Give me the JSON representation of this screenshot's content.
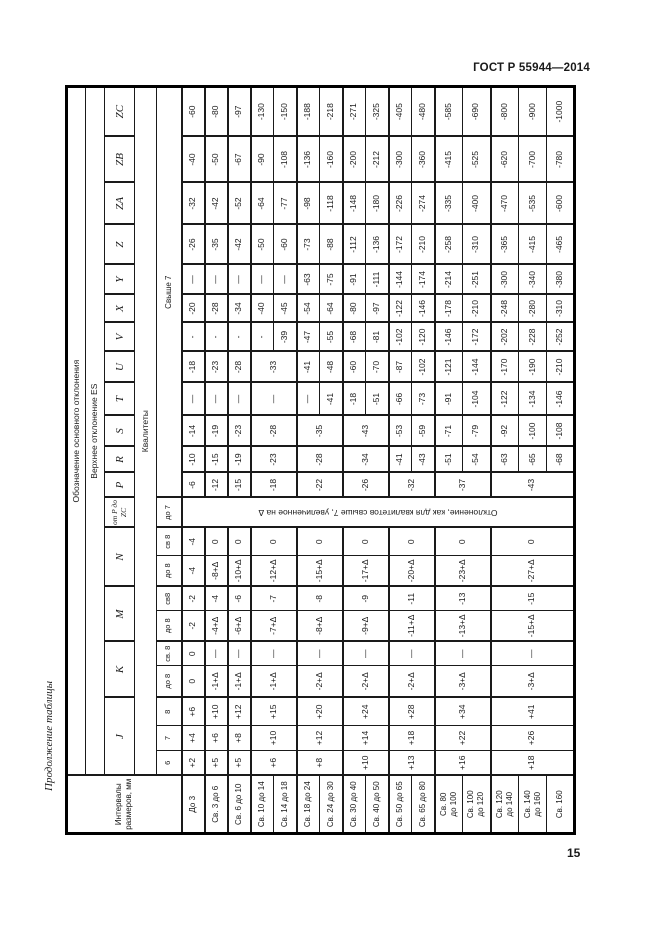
{
  "page": {
    "standard": "ГОСТ Р 55944—2014",
    "number": "15",
    "continuation": "Продолжение таблицы"
  },
  "table": {
    "corner": "Интервалы размеров, мм",
    "h1": "Обозначение основного отклонения",
    "h2": "Верхнее отклонение ES",
    "h4": "Квалитеты",
    "letters": [
      {
        "label": "J",
        "span": 3
      },
      {
        "label": "K",
        "span": 2
      },
      {
        "label": "M",
        "span": 2
      },
      {
        "label": "N",
        "span": 2
      },
      {
        "label": "от P до ZC",
        "span": 1
      },
      {
        "label": "P",
        "span": 1
      },
      {
        "label": "R",
        "span": 1
      },
      {
        "label": "S",
        "span": 1
      },
      {
        "label": "T",
        "span": 1
      },
      {
        "label": "U",
        "span": 1
      },
      {
        "label": "V",
        "span": 1
      },
      {
        "label": "X",
        "span": 1
      },
      {
        "label": "Y",
        "span": 1
      },
      {
        "label": "Z",
        "span": 1
      },
      {
        "label": "ZA",
        "span": 1
      },
      {
        "label": "ZB",
        "span": 1
      },
      {
        "label": "ZC",
        "span": 1
      }
    ],
    "grades": [
      {
        "label": "6",
        "span": 1
      },
      {
        "label": "7",
        "span": 1
      },
      {
        "label": "8",
        "span": 1
      },
      {
        "label": "до 8",
        "span": 1
      },
      {
        "label": "св. 8",
        "span": 1
      },
      {
        "label": "до 8",
        "span": 1
      },
      {
        "label": "св8",
        "span": 1
      },
      {
        "label": "до 8",
        "span": 1
      },
      {
        "label": "св 8",
        "span": 1
      },
      {
        "label": "до 7",
        "span": 1
      },
      {
        "label": "Свыше 7",
        "span": 12
      }
    ],
    "intervals": [
      [
        "До 3"
      ],
      [
        "Св. 3 до 6"
      ],
      [
        "Св. 6 до 10"
      ],
      [
        "Св. 10 до 14"
      ],
      [
        "Св. 14 до 18"
      ],
      [
        "Св. 18 до 24"
      ],
      [
        "Св. 24 до 30"
      ],
      [
        "Св. 30 до 40"
      ],
      [
        "Св. 40 до 50"
      ],
      [
        "Св. 50 до 65"
      ],
      [
        "Св. 65 до 80"
      ],
      [
        "Св. 80",
        "до 100"
      ],
      [
        "Св. 100",
        "до 120"
      ],
      [
        "Св. 120",
        "до 140"
      ],
      [
        "Св. 140",
        "до 160"
      ],
      [
        "Св. 160"
      ]
    ],
    "columns": [
      {
        "id": "j-6",
        "groups": [
          [
            "+2",
            1
          ],
          [
            "+5",
            1
          ],
          [
            "+5",
            1
          ],
          [
            "+6",
            2
          ],
          [
            "+8",
            2
          ],
          [
            "+10",
            2
          ],
          [
            "+13",
            2
          ],
          [
            "+16",
            2
          ],
          [
            "+18",
            3
          ]
        ]
      },
      {
        "id": "j-7",
        "groups": [
          [
            "+4",
            1
          ],
          [
            "+6",
            1
          ],
          [
            "+8",
            1
          ],
          [
            "+10",
            2
          ],
          [
            "+12",
            2
          ],
          [
            "+14",
            2
          ],
          [
            "+18",
            2
          ],
          [
            "+22",
            2
          ],
          [
            "+26",
            3
          ]
        ]
      },
      {
        "id": "j-8",
        "groups": [
          [
            "+6",
            1
          ],
          [
            "+10",
            1
          ],
          [
            "+12",
            1
          ],
          [
            "+15",
            2
          ],
          [
            "+20",
            2
          ],
          [
            "+24",
            2
          ],
          [
            "+28",
            2
          ],
          [
            "+34",
            2
          ],
          [
            "+41",
            3
          ]
        ]
      },
      {
        "id": "k-do-8",
        "groups": [
          [
            "0",
            1
          ],
          [
            "-1+Δ",
            1
          ],
          [
            "-1+Δ",
            1
          ],
          [
            "-1+Δ",
            2
          ],
          [
            "-2+Δ",
            2
          ],
          [
            "-2+Δ",
            2
          ],
          [
            "-2+Δ",
            2
          ],
          [
            "-3+Δ",
            2
          ],
          [
            "-3+Δ",
            3
          ]
        ]
      },
      {
        "id": "k-sv-8",
        "groups": [
          [
            "0",
            1
          ],
          [
            "—",
            1
          ],
          [
            "—",
            1
          ],
          [
            "—",
            2
          ],
          [
            "—",
            2
          ],
          [
            "—",
            2
          ],
          [
            "—",
            2
          ],
          [
            "—",
            2
          ],
          [
            "—",
            3
          ]
        ]
      },
      {
        "id": "m-do-8",
        "groups": [
          [
            "-2",
            1
          ],
          [
            "-4+Δ",
            1
          ],
          [
            "-6+Δ",
            1
          ],
          [
            "-7+Δ",
            2
          ],
          [
            "-8+Δ",
            2
          ],
          [
            "-9+Δ",
            2
          ],
          [
            "-11+Δ",
            2
          ],
          [
            "-13+Δ",
            2
          ],
          [
            "-15+Δ",
            3
          ]
        ]
      },
      {
        "id": "m-sv-8",
        "groups": [
          [
            "-2",
            1
          ],
          [
            "-4",
            1
          ],
          [
            "-6",
            1
          ],
          [
            "-7",
            2
          ],
          [
            "-8",
            2
          ],
          [
            "-9",
            2
          ],
          [
            "-11",
            2
          ],
          [
            "-13",
            2
          ],
          [
            "-15",
            3
          ]
        ]
      },
      {
        "id": "n-do-8",
        "groups": [
          [
            "-4",
            1
          ],
          [
            "-8+Δ",
            1
          ],
          [
            "-10+Δ",
            1
          ],
          [
            "-12+Δ",
            2
          ],
          [
            "-15+Δ",
            2
          ],
          [
            "-17+Δ",
            2
          ],
          [
            "-20+Δ",
            2
          ],
          [
            "-23+Δ",
            2
          ],
          [
            "-27+Δ",
            3
          ]
        ]
      },
      {
        "id": "n-sv-8",
        "groups": [
          [
            "-4",
            1
          ],
          [
            "0",
            1
          ],
          [
            "0",
            1
          ],
          [
            "0",
            2
          ],
          [
            "0",
            2
          ],
          [
            "0",
            2
          ],
          [
            "0",
            2
          ],
          [
            "0",
            2
          ],
          [
            "0",
            3
          ]
        ]
      },
      {
        "id": "p-to-zc-note",
        "note": true,
        "groups": [
          [
            "Отклонение, как для квалитетов свыше 7, увеличенное на Δ",
            16
          ]
        ]
      },
      {
        "id": "p",
        "groups": [
          [
            "-6",
            1
          ],
          [
            "-12",
            1
          ],
          [
            "-15",
            1
          ],
          [
            "-18",
            2
          ],
          [
            "-22",
            2
          ],
          [
            "-26",
            2
          ],
          [
            "-32",
            2
          ],
          [
            "-37",
            2
          ],
          [
            "-43",
            3
          ]
        ]
      },
      {
        "id": "r",
        "groups": [
          [
            "-10",
            1
          ],
          [
            "-15",
            1
          ],
          [
            "-19",
            1
          ],
          [
            "-23",
            2
          ],
          [
            "-28",
            2
          ],
          [
            "-34",
            2
          ],
          [
            "-41",
            1
          ],
          [
            "-43",
            1
          ],
          [
            "-51",
            1
          ],
          [
            "-54",
            1
          ],
          [
            "-63",
            1
          ],
          [
            "-65",
            1
          ],
          [
            "-68",
            1
          ]
        ]
      },
      {
        "id": "s",
        "groups": [
          [
            "-14",
            1
          ],
          [
            "-19",
            1
          ],
          [
            "-23",
            1
          ],
          [
            "-28",
            2
          ],
          [
            "-35",
            2
          ],
          [
            "-43",
            2
          ],
          [
            "-53",
            1
          ],
          [
            "-59",
            1
          ],
          [
            "-71",
            1
          ],
          [
            "-79",
            1
          ],
          [
            "-92",
            1
          ],
          [
            "-100",
            1
          ],
          [
            "-108",
            1
          ]
        ]
      },
      {
        "id": "t",
        "groups": [
          [
            "—",
            1
          ],
          [
            "—",
            1
          ],
          [
            "—",
            1
          ],
          [
            "—",
            2
          ],
          [
            "—",
            1
          ],
          [
            "-41",
            1
          ],
          [
            "-18",
            1
          ],
          [
            "-51",
            1
          ],
          [
            "-66",
            1
          ],
          [
            "-73",
            1
          ],
          [
            "-91",
            1
          ],
          [
            "-104",
            1
          ],
          [
            "-122",
            1
          ],
          [
            "-134",
            1
          ],
          [
            "-146",
            1
          ]
        ]
      },
      {
        "id": "u",
        "groups": [
          [
            "-18",
            1
          ],
          [
            "-23",
            1
          ],
          [
            "-28",
            1
          ],
          [
            "-33",
            2
          ],
          [
            "-41",
            1
          ],
          [
            "-48",
            1
          ],
          [
            "-60",
            1
          ],
          [
            "-70",
            1
          ],
          [
            "-87",
            1
          ],
          [
            "-102",
            1
          ],
          [
            "-121",
            1
          ],
          [
            "-144",
            1
          ],
          [
            "-170",
            1
          ],
          [
            "-190",
            1
          ],
          [
            "-210",
            1
          ]
        ]
      },
      {
        "id": "v",
        "groups": [
          [
            "-",
            1
          ],
          [
            "-",
            1
          ],
          [
            "-",
            1
          ],
          [
            "-",
            1
          ],
          [
            "-39",
            1
          ],
          [
            "-47",
            1
          ],
          [
            "-55",
            1
          ],
          [
            "-68",
            1
          ],
          [
            "-81",
            1
          ],
          [
            "-102",
            1
          ],
          [
            "-120",
            1
          ],
          [
            "-146",
            1
          ],
          [
            "-172",
            1
          ],
          [
            "-202",
            1
          ],
          [
            "-228",
            1
          ],
          [
            "-252",
            1
          ]
        ]
      },
      {
        "id": "x",
        "groups": [
          [
            "-20",
            1
          ],
          [
            "-28",
            1
          ],
          [
            "-34",
            1
          ],
          [
            "-40",
            1
          ],
          [
            "-45",
            1
          ],
          [
            "-54",
            1
          ],
          [
            "-64",
            1
          ],
          [
            "-80",
            1
          ],
          [
            "-97",
            1
          ],
          [
            "-122",
            1
          ],
          [
            "-146",
            1
          ],
          [
            "-178",
            1
          ],
          [
            "-210",
            1
          ],
          [
            "-248",
            1
          ],
          [
            "-280",
            1
          ],
          [
            "-310",
            1
          ]
        ]
      },
      {
        "id": "y",
        "groups": [
          [
            "—",
            1
          ],
          [
            "—",
            1
          ],
          [
            "—",
            1
          ],
          [
            "—",
            1
          ],
          [
            "—",
            1
          ],
          [
            "-63",
            1
          ],
          [
            "-75",
            1
          ],
          [
            "-91",
            1
          ],
          [
            "-111",
            1
          ],
          [
            "-144",
            1
          ],
          [
            "-174",
            1
          ],
          [
            "-214",
            1
          ],
          [
            "-251",
            1
          ],
          [
            "-300",
            1
          ],
          [
            "-340",
            1
          ],
          [
            "-380",
            1
          ]
        ]
      },
      {
        "id": "z",
        "groups": [
          [
            "-26",
            1
          ],
          [
            "-35",
            1
          ],
          [
            "-42",
            1
          ],
          [
            "-50",
            1
          ],
          [
            "-60",
            1
          ],
          [
            "-73",
            1
          ],
          [
            "-88",
            1
          ],
          [
            "-112",
            1
          ],
          [
            "-136",
            1
          ],
          [
            "-172",
            1
          ],
          [
            "-210",
            1
          ],
          [
            "-258",
            1
          ],
          [
            "-310",
            1
          ],
          [
            "-365",
            1
          ],
          [
            "-415",
            1
          ],
          [
            "-465",
            1
          ]
        ]
      },
      {
        "id": "za",
        "groups": [
          [
            "-32",
            1
          ],
          [
            "-42",
            1
          ],
          [
            "-52",
            1
          ],
          [
            "-64",
            1
          ],
          [
            "-77",
            1
          ],
          [
            "-98",
            1
          ],
          [
            "-118",
            1
          ],
          [
            "-148",
            1
          ],
          [
            "-180",
            1
          ],
          [
            "-226",
            1
          ],
          [
            "-274",
            1
          ],
          [
            "-335",
            1
          ],
          [
            "-400",
            1
          ],
          [
            "-470",
            1
          ],
          [
            "-535",
            1
          ],
          [
            "-600",
            1
          ]
        ]
      },
      {
        "id": "zb",
        "groups": [
          [
            "-40",
            1
          ],
          [
            "-50",
            1
          ],
          [
            "-67",
            1
          ],
          [
            "-90",
            1
          ],
          [
            "-108",
            1
          ],
          [
            "-136",
            1
          ],
          [
            "-160",
            1
          ],
          [
            "-200",
            1
          ],
          [
            "-212",
            1
          ],
          [
            "-300",
            1
          ],
          [
            "-360",
            1
          ],
          [
            "-415",
            1
          ],
          [
            "-525",
            1
          ],
          [
            "-620",
            1
          ],
          [
            "-700",
            1
          ],
          [
            "-780",
            1
          ]
        ]
      },
      {
        "id": "zc",
        "groups": [
          [
            "-60",
            1
          ],
          [
            "-80",
            1
          ],
          [
            "-97",
            1
          ],
          [
            "-130",
            1
          ],
          [
            "-150",
            1
          ],
          [
            "-188",
            1
          ],
          [
            "-218",
            1
          ],
          [
            "-271",
            1
          ],
          [
            "-325",
            1
          ],
          [
            "-405",
            1
          ],
          [
            "-480",
            1
          ],
          [
            "-585",
            1
          ],
          [
            "-690",
            1
          ],
          [
            "-800",
            1
          ],
          [
            "-900",
            1
          ],
          [
            "-1000",
            1
          ]
        ]
      }
    ]
  }
}
